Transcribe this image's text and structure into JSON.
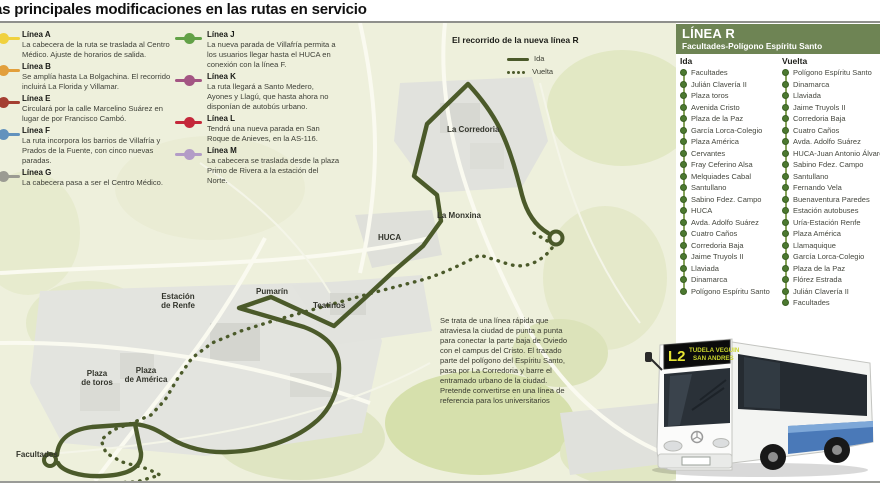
{
  "title": "as principales modificaciones en las rutas en servicio",
  "legend": {
    "items": [
      {
        "line": "Línea A",
        "color": "#f0d13e",
        "desc": "La cabecera de la ruta se traslada al Centro Médico. Ajuste de horarios de salida."
      },
      {
        "line": "Línea B",
        "color": "#e29f3c",
        "desc": "Se amplía hasta La Bolgachina. El recorrido incluirá La Florida y Villamar."
      },
      {
        "line": "Línea E",
        "color": "#a43f32",
        "desc": "Circulará por la calle Marcelino Suárez en lugar de por Francisco Cambó."
      },
      {
        "line": "Línea F",
        "color": "#6292bd",
        "desc": "La ruta incorpora los barrios de Villafría y Prados de la Fuente, con cinco nuevas paradas."
      },
      {
        "line": "Línea G",
        "color": "#9b9b93",
        "desc": "La cabecera pasa a ser el Centro Médico."
      },
      {
        "line": "Línea J",
        "color": "#62a147",
        "desc": "La nueva parada de Villafría permita a los usuarios llegar hasta el HUCA en conexión con la línea F."
      },
      {
        "line": "Línea K",
        "color": "#a35583",
        "desc": "La ruta llegará a Santo Medero, Ayones y Llagú, que hasta ahora no disponían de autobús urbano."
      },
      {
        "line": "Línea L",
        "color": "#c4273a",
        "desc": "Tendrá una nueva parada en San Roque de Anieves, en la AS-116."
      },
      {
        "line": "Línea M",
        "color": "#b39cc7",
        "desc": "La cabecera se traslada desde la plaza Primo de Rivera a la estación del Norte."
      }
    ]
  },
  "map": {
    "route_title": "El recorrido de la nueva línea R",
    "route_legend": {
      "ida": "Ida",
      "vuelta": "Vuelta"
    },
    "route_color": "#4b5a2a",
    "labels": [
      {
        "text": "La Corredoria",
        "x": 447,
        "y": 102,
        "align": "left"
      },
      {
        "text": "La Monxina",
        "x": 437,
        "y": 188,
        "align": "left"
      },
      {
        "text": "HUCA",
        "x": 378,
        "y": 210,
        "align": "left"
      },
      {
        "text": "Pumarín",
        "x": 256,
        "y": 264,
        "align": "left"
      },
      {
        "text": "Teatinos",
        "x": 313,
        "y": 278,
        "align": "left"
      },
      {
        "text": "Estación\nde Renfe",
        "x": 178,
        "y": 269,
        "align": "center"
      },
      {
        "text": "Plaza\nde toros",
        "x": 97,
        "y": 346,
        "align": "center"
      },
      {
        "text": "Plaza\nde América",
        "x": 146,
        "y": 343,
        "align": "center"
      },
      {
        "text": "Facultades",
        "x": 16,
        "y": 427,
        "align": "left"
      }
    ],
    "description": "Se trata de una línea rápida que atraviesa la ciudad de punta a punta para conectar la parte baja de Oviedo con el campus del Cristo. El trazado parte del polígono del Espíritu Santo, pasa por La Corredoria y barre el entramado urbano de la ciudad. Pretende convertirse en una línea de referencia para los universitarios"
  },
  "panel": {
    "title": "LÍNEA R",
    "subtitle": "Facultades-Polígono Espíritu Santo",
    "accent_color": "#6e8454",
    "ida": {
      "header": "Ida",
      "stops": [
        "Facultades",
        "Julián Clavería II",
        "Plaza toros",
        "Avenida Cristo",
        "Plaza de la Paz",
        "García Lorca-Colegio",
        "Plaza América",
        "Cervantes",
        "Fray Ceferino Alsa",
        "Melquiades Cabal",
        "Santullano",
        "Sabino Fdez. Campo",
        "HUCA",
        "Avda. Adolfo Suárez",
        "Cuatro Caños",
        "Corredoria Baja",
        "Jaime Truyols II",
        "Llaviada",
        "Dinamarca",
        "Polígono Espíritu Santo"
      ]
    },
    "vuelta": {
      "header": "Vuelta",
      "stops": [
        "Polígono Espíritu Santo",
        "Dinamarca",
        "Llaviada",
        "Jaime Truyols II",
        "Corredoria Baja",
        "Cuatro Caños",
        "Avda. Adolfo Suárez",
        "HUCA-Juan Antonio Álvarez",
        "Sabino Fdez. Campo",
        "Santullano",
        "Fernando Vela",
        "Buenaventura Paredes",
        "Estación autobuses",
        "Uría-Estación Renfe",
        "Plaza América",
        "Llamaquique",
        "García Lorca-Colegio",
        "Plaza de la Paz",
        "Flórez Estrada",
        "Julián Clavería II",
        "Facultades"
      ]
    }
  },
  "bus": {
    "display_line": "L2",
    "display_dest1": "TUDELA VEGUIN",
    "display_dest2": "SAN ANDRES"
  }
}
